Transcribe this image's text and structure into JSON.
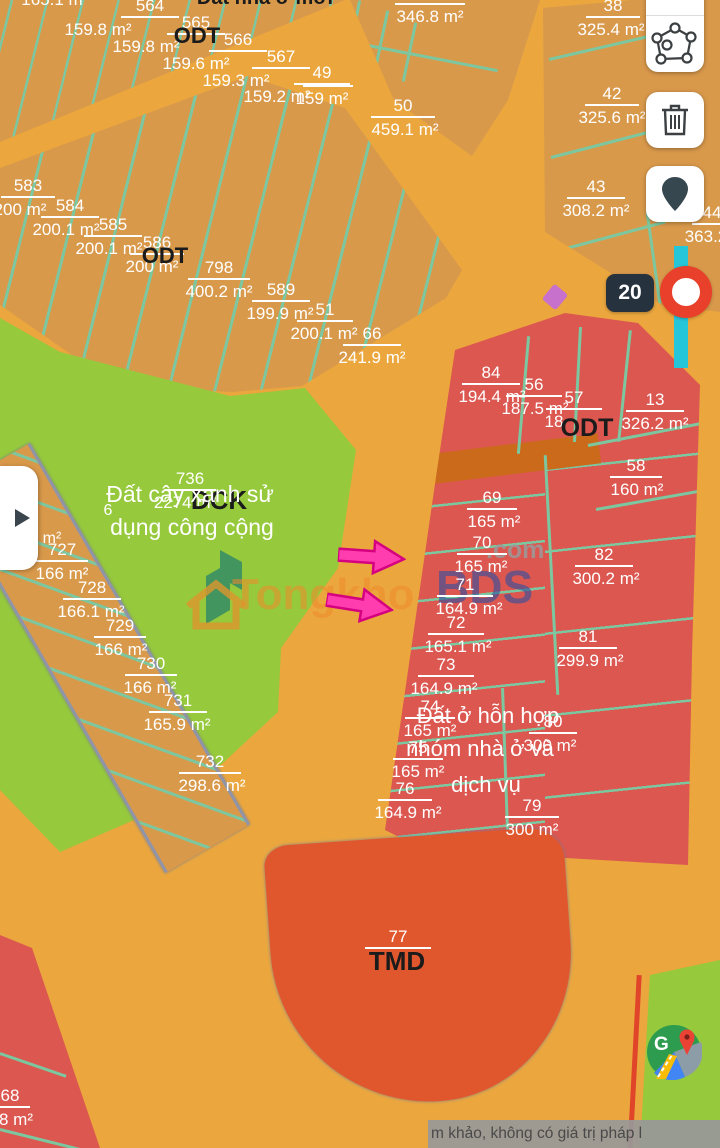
{
  "map": {
    "marker": {
      "label": "20"
    },
    "disclaimer": "m khảo, không có giá trị pháp l",
    "watermark": {
      "prefix": "Tongkho",
      "suffix": "BDS",
      "domain": ".com"
    },
    "colors": {
      "road": "#EBA73E",
      "parcel_tan": "#D9994B",
      "teal_line": "#7CC7A0",
      "green_zone": "#96C93C",
      "red_zone": "#DB5750",
      "tmd_zone": "#E0572E",
      "dark_road_strip": "#CB6A1A",
      "cyan_road": "#26C6DA",
      "marker_ring": "#E8402A",
      "badge_bg": "#26323E",
      "arrow_pink": "#FF3DAE"
    },
    "ui_icons": [
      "measure-icon",
      "draw-polygon-icon",
      "trash-icon",
      "location-pin-icon",
      "play-icon",
      "google-maps-icon"
    ],
    "parcel_labels": [
      {
        "n": "564",
        "a": "159.8 m²",
        "x": 150,
        "y": -4,
        "w": 58,
        "adx": -52
      },
      {
        "n": "565",
        "a": "159.8 m²",
        "x": 196,
        "y": 13,
        "w": 58,
        "adx": -50
      },
      {
        "n": "566",
        "a": "159.6 m²",
        "x": 238,
        "y": 30,
        "w": 58,
        "adx": -42
      },
      {
        "n": "567",
        "a": "159.3 m²",
        "x": 281,
        "y": 47,
        "w": 58,
        "adx": -45
      },
      {
        "n": "49",
        "a": "159.2 m²",
        "x": 322,
        "y": 63,
        "w": 56,
        "adx": -45
      },
      {
        "n": "",
        "a": "159 m²",
        "x": 328,
        "y": 84,
        "w": 50,
        "adx": -6
      },
      {
        "n": "",
        "a": "346.8 m²",
        "x": 430,
        "y": 2,
        "w": 70,
        "adx": 0
      },
      {
        "n": "50",
        "a": "459.1 m²",
        "x": 403,
        "y": 96,
        "w": 64,
        "adx": 2
      },
      {
        "n": "38",
        "a": "325.4 m²",
        "x": 613,
        "y": -4,
        "w": 54,
        "adx": -2
      },
      {
        "n": "42",
        "a": "325.6 m²",
        "x": 612,
        "y": 84,
        "w": 54,
        "adx": 0
      },
      {
        "n": "43",
        "a": "308.2 m²",
        "x": 596,
        "y": 177,
        "w": 58,
        "adx": 0
      },
      {
        "n": "44",
        "a": "363.2",
        "x": 712,
        "y": 203,
        "w": 40,
        "adx": -6
      },
      {
        "n": "583",
        "a": "200 m²",
        "x": 28,
        "y": 176,
        "w": 54,
        "adx": -8
      },
      {
        "n": "584",
        "a": "200.1 m²",
        "x": 70,
        "y": 196,
        "w": 58,
        "adx": -4
      },
      {
        "n": "585",
        "a": "200.1 m²",
        "x": 113,
        "y": 215,
        "w": 58,
        "adx": -4
      },
      {
        "n": "586",
        "a": "200 m²",
        "x": 157,
        "y": 233,
        "w": 54,
        "adx": -5
      },
      {
        "n": "798",
        "a": "400.2 m²",
        "x": 219,
        "y": 258,
        "w": 62,
        "adx": 0
      },
      {
        "n": "589",
        "a": "199.9 m²",
        "x": 281,
        "y": 280,
        "w": 58,
        "adx": -1
      },
      {
        "n": "51",
        "a": "200.1 m²",
        "x": 325,
        "y": 300,
        "w": 56,
        "adx": -1
      },
      {
        "n": "66",
        "a": "241.9 m²",
        "x": 372,
        "y": 324,
        "w": 58,
        "adx": 0
      },
      {
        "n": "727",
        "a": "166 m²",
        "x": 62,
        "y": 540,
        "w": 52,
        "adx": 0
      },
      {
        "n": "728",
        "a": "166.1 m²",
        "x": 92,
        "y": 578,
        "w": 58,
        "adx": -1
      },
      {
        "n": "729",
        "a": "166 m²",
        "x": 120,
        "y": 616,
        "w": 52,
        "adx": 1
      },
      {
        "n": "730",
        "a": "166 m²",
        "x": 151,
        "y": 654,
        "w": 52,
        "adx": -1
      },
      {
        "n": "731",
        "a": "165.9 m²",
        "x": 178,
        "y": 691,
        "w": 58,
        "adx": -1
      },
      {
        "n": "732",
        "a": "298.6 m²",
        "x": 210,
        "y": 752,
        "w": 62,
        "adx": 2
      },
      {
        "n": "736",
        "a": "2274 m²",
        "x": 190,
        "y": 469,
        "w": 52,
        "adx": -5
      },
      {
        "n": "84",
        "a": "194.4 m²",
        "x": 491,
        "y": 363,
        "w": 58,
        "adx": 1
      },
      {
        "n": "56",
        "a": "187.5 m²",
        "x": 534,
        "y": 375,
        "w": 56,
        "adx": 1
      },
      {
        "n": "57",
        "a": "18",
        "x": 574,
        "y": 388,
        "w": 56,
        "adx": -20
      },
      {
        "n": "13",
        "a": "326.2 m²",
        "x": 655,
        "y": 390,
        "w": 58,
        "adx": 0
      },
      {
        "n": "58",
        "a": "160 m²",
        "x": 636,
        "y": 456,
        "w": 52,
        "adx": 1
      },
      {
        "n": "69",
        "a": "165 m²",
        "x": 492,
        "y": 488,
        "w": 50,
        "adx": 2
      },
      {
        "n": "70",
        "a": "165 m²",
        "x": 482,
        "y": 533,
        "w": 50,
        "adx": -1
      },
      {
        "n": "71",
        "a": "164.9 m²",
        "x": 465,
        "y": 575,
        "w": 56,
        "adx": 4
      },
      {
        "n": "72",
        "a": "165.1 m²",
        "x": 456,
        "y": 613,
        "w": 56,
        "adx": 2
      },
      {
        "n": "73",
        "a": "164.9 m²",
        "x": 446,
        "y": 655,
        "w": 56,
        "adx": -2
      },
      {
        "n": "74",
        "a": "165 m²",
        "x": 430,
        "y": 697,
        "w": 50,
        "adx": 0
      },
      {
        "n": "75",
        "a": "165 m²",
        "x": 418,
        "y": 738,
        "w": 50,
        "adx": 0
      },
      {
        "n": "76",
        "a": "164.9 m²",
        "x": 405,
        "y": 779,
        "w": 54,
        "adx": 3
      },
      {
        "n": "82",
        "a": "300.2 m²",
        "x": 604,
        "y": 545,
        "w": 58,
        "adx": 2
      },
      {
        "n": "81",
        "a": "299.9 m²",
        "x": 588,
        "y": 627,
        "w": 58,
        "adx": 2
      },
      {
        "n": "80",
        "a": "300 m²",
        "x": 553,
        "y": 712,
        "w": 48,
        "adx": -3
      },
      {
        "n": "79",
        "a": "300 m²",
        "x": 532,
        "y": 796,
        "w": 54,
        "adx": 0
      },
      {
        "n": "77",
        "a": "",
        "x": 398,
        "y": 927,
        "w": 66,
        "adx": 0
      },
      {
        "n": "68",
        "a": "8 m²",
        "x": 10,
        "y": 1086,
        "w": 40,
        "adx": 6
      }
    ],
    "texts": [
      {
        "t": "Đất nhà ở mới",
        "x": 265,
        "y": -13,
        "s": 20,
        "c": "#1b1b1b",
        "w": 700
      },
      {
        "t": "165.1 m",
        "x": 52,
        "y": -9,
        "s": 17,
        "c": "#ffffff",
        "w": 400
      },
      {
        "t": "ODT",
        "x": 197,
        "y": 24,
        "s": 22,
        "c": "#1b1b1b",
        "w": 700
      },
      {
        "t": "ODT",
        "x": 165,
        "y": 244,
        "s": 22,
        "c": "#1b1b1b",
        "w": 700
      },
      {
        "t": "ODT",
        "x": 587,
        "y": 415,
        "s": 25,
        "c": "#1b1b1b",
        "w": 700
      },
      {
        "t": "DCK",
        "x": 219,
        "y": 486,
        "s": 26,
        "c": "#1b1b1b",
        "w": 700
      },
      {
        "t": "TMD",
        "x": 397,
        "y": 947,
        "s": 26,
        "c": "#1b1b1b",
        "w": 700
      },
      {
        "t": "Đất cây xanh sử",
        "x": 190,
        "y": 482,
        "s": 23,
        "c": "#ffffff",
        "w": 400
      },
      {
        "t": "dụng công cộng",
        "x": 192,
        "y": 515,
        "s": 23,
        "c": "#ffffff",
        "w": 400
      },
      {
        "t": "Đất ở hỗn hợp",
        "x": 488,
        "y": 704,
        "s": 22,
        "c": "#ffffff",
        "w": 400
      },
      {
        "t": "nhóm nhà ở và",
        "x": 480,
        "y": 737,
        "s": 22,
        "c": "#ffffff",
        "w": 400
      },
      {
        "t": "dịch vụ",
        "x": 486,
        "y": 773,
        "s": 22,
        "c": "#ffffff",
        "w": 400
      },
      {
        "t": "6",
        "x": 108,
        "y": 502,
        "s": 16,
        "c": "#ffffff",
        "w": 400
      },
      {
        "t": "m²",
        "x": 52,
        "y": 530,
        "s": 16,
        "c": "#ffffff",
        "w": 400
      }
    ]
  }
}
